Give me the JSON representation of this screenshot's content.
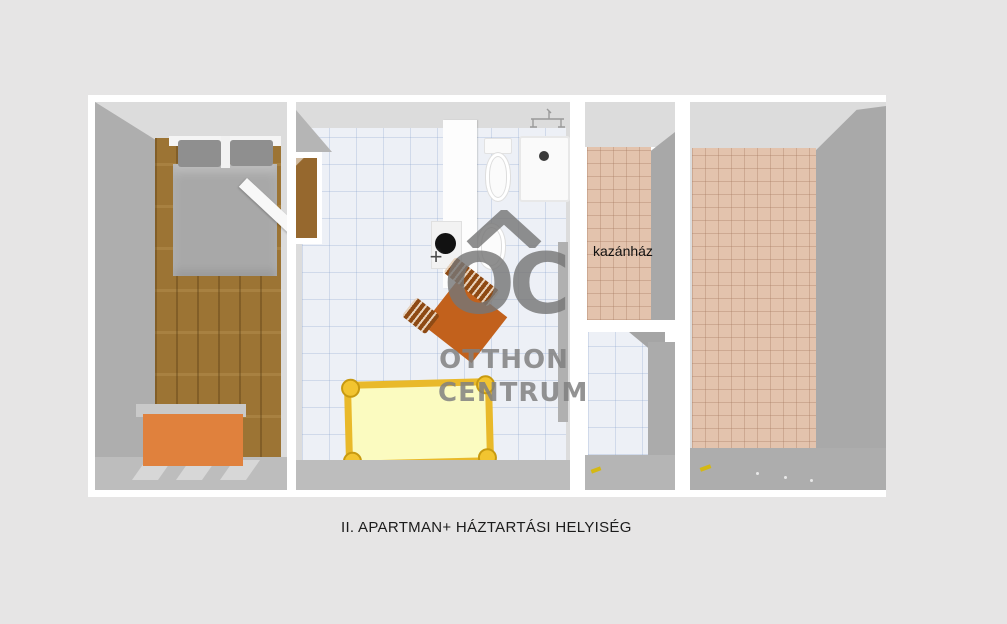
{
  "caption": "II. APARTMAN+ HÁZTARTÁSI HELYISÉG",
  "labels": {
    "boiler_room": "kazánház"
  },
  "watermark": {
    "logo": "OC",
    "line1": "OTTHON",
    "line2": "CENTRUM"
  },
  "colors": {
    "background": "#e6e5e5",
    "plan_frame": "#ffffff",
    "wall_top": "#dcdcdc",
    "wall_side": "#aeaeae",
    "wall_bottom": "#bdbdbd",
    "parquet": "#9c7434",
    "tile_white": "#edf0f6",
    "tile_salmon": "#e3c3ad",
    "bed_gray": "#a8a8a8",
    "pillow_gray": "#8f8f8f",
    "dresser_orange": "#e0813d",
    "chair_orange": "#c2611c",
    "chair_dark": "#8e4a14",
    "cot_yellow": "#e9b92a",
    "cot_fill": "#fbfbc0",
    "handle_yellow": "#d4b814",
    "watermark_gray": "#7a7a7a",
    "caption_text": "#1c1c1c",
    "label_text": "#111111"
  }
}
